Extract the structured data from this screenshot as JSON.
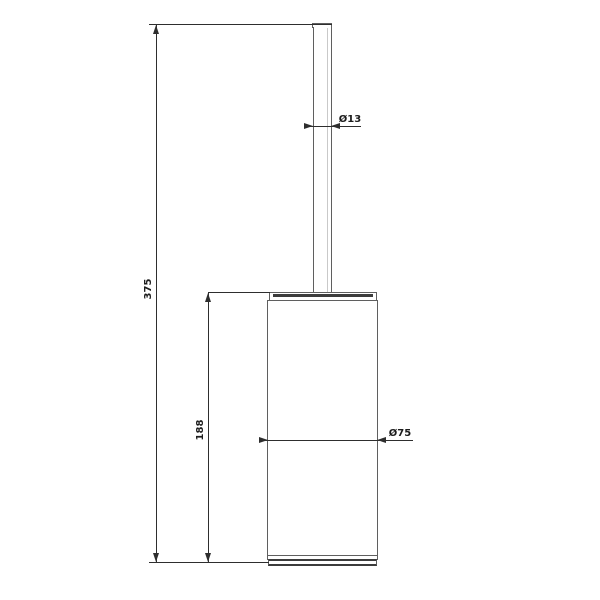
{
  "drawing": {
    "subject": "toilet-brush-holder",
    "view": "front-elevation-technical-drawing",
    "colors": {
      "background": "#ffffff",
      "outline": "#5f5f5f",
      "dark_band": "#3c3c3c",
      "dimension_line": "#2e2e2e",
      "label_text": "#1c1c1c"
    }
  },
  "dimensions": {
    "total_height": "375",
    "container_height": "188",
    "handle_diameter": "Ø13",
    "container_diameter": "Ø75"
  }
}
